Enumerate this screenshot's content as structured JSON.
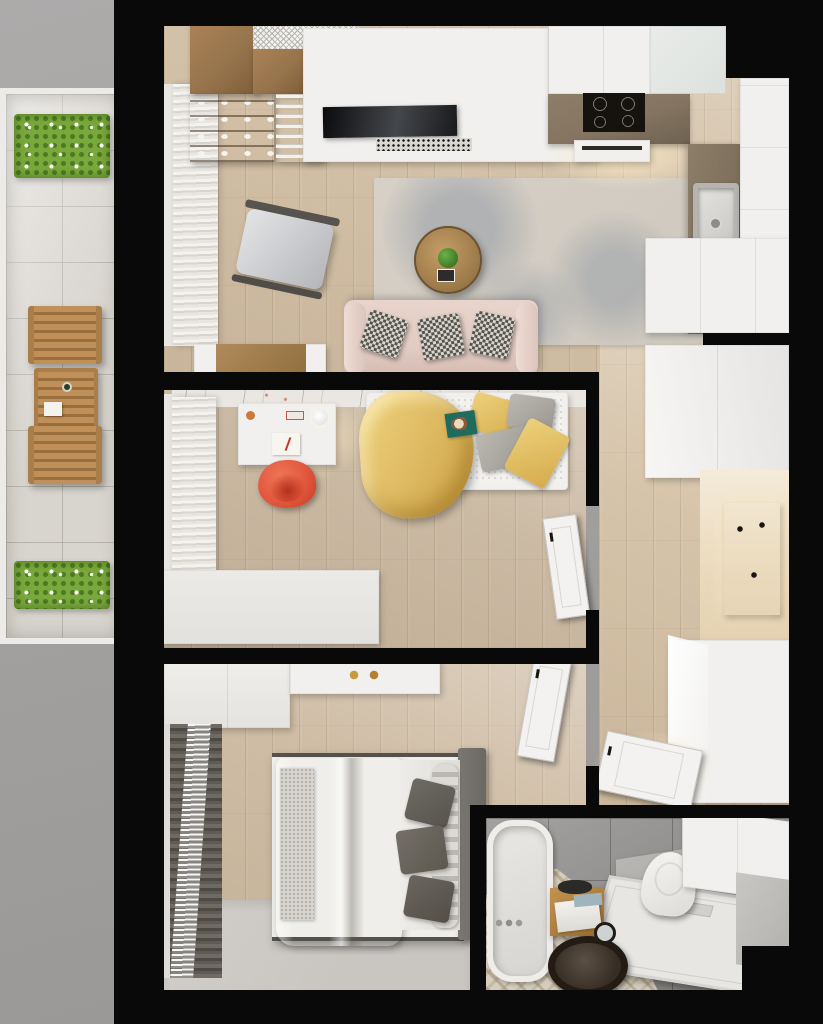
{
  "meta": {
    "type": "3d-rendered-floor-plan",
    "view": "top-down",
    "visible_text": "none",
    "canvas": {
      "width_px": 823,
      "height_px": 1024
    }
  },
  "palette": {
    "exterior_ground": "#a3a1a0",
    "exterior_ground_light": "#adabaa",
    "wall": "#090909",
    "wood_floor": "#d4c2a9",
    "balcony_tile": "#d8d4ce",
    "balcony_frame": "#edebe7",
    "plant_green": "#79a83c",
    "wood_furniture": "#96744c",
    "entry_panel_wood": "#b38240",
    "white_furniture": "#f1f0ee",
    "marble": "#eae7e2",
    "rug_living": "#cdc7bd",
    "sofa_pink": "#e2ccc4",
    "pillow_dark": "#55534b",
    "yellow_blanket": "#e0bd66",
    "accent_chair_red": "#e0563c",
    "teal_accent": "#1f6b5e",
    "kitchen_counter": "#847461",
    "cooktop_black": "#16130e",
    "sink_steel": "#c9c8c4",
    "gray_bed": "#a39e98",
    "bed_headboard": "#6b6862",
    "bedroom_rug": "#c9c6c2",
    "curtain_light": "#e9e6e1",
    "curtain_dark": "#4d4943",
    "bathroom_wall_tile": "#8f8d8b",
    "bathroom_floor_mosaic": "#d6cdbd",
    "shower_tray": "#e8e6e3",
    "door_white": "#f3f2f0"
  },
  "rooms": [
    {
      "id": "balcony",
      "name": "Balcony",
      "floor": "stone tile",
      "furniture": [
        "planter box (top)",
        "folding wood chair",
        "slatted wood table",
        "folding wood chair",
        "planter box (bottom)"
      ]
    },
    {
      "id": "living-room",
      "name": "Living room",
      "floor": "light oak plank",
      "furniture": [
        "wood wardrobe",
        "wood hutch",
        "open shelf unit with dishes",
        "bookshelf",
        "mesh vent panel",
        "white TV wall unit",
        "TV",
        "speckled media mat",
        "light curtains",
        "armchair with wood frame",
        "area rug",
        "round wood coffee table with plant",
        "pink sofa with patterned pillows",
        "desk with wood top"
      ]
    },
    {
      "id": "kitchen",
      "name": "Kitchen",
      "floor": "light oak plank",
      "furniture": [
        "upper cabinet run",
        "glass upper cabinet",
        "counter with cooktop",
        "built-in oven",
        "side counter with sink",
        "tall cabinet column",
        "lower cabinet block"
      ]
    },
    {
      "id": "office",
      "name": "Office / guest room",
      "floor": "light oak plank",
      "furniture": [
        "marble wall band",
        "light curtains",
        "desk with lamp and open book",
        "red shell chair",
        "white sideboard",
        "daybed with yellow blanket",
        "yellow and gray pillows",
        "teal book",
        "interior door (ajar)"
      ]
    },
    {
      "id": "hallway",
      "name": "Hallway / entry",
      "floor": "light oak plank",
      "furniture": [
        "tall wardrobe",
        "lit entry wall",
        "wood coat panel with hooks",
        "entry bench cabinet",
        "open bathroom door"
      ]
    },
    {
      "id": "bedroom",
      "name": "Bedroom",
      "floor": "light oak plank + gray rug",
      "furniture": [
        "wardrobe",
        "desk",
        "dark curtains",
        "double bed with gray duvet",
        "textured runner",
        "dark gray pillows",
        "rolled blanket",
        "dark headboard",
        "gray floor rug",
        "interior door (ajar)"
      ]
    },
    {
      "id": "bathroom",
      "name": "Bathroom",
      "floor": "mosaic tile",
      "furniture": [
        "bathtub",
        "gray ledge",
        "toilet",
        "angled shower tray",
        "wall cabinets",
        "wood stool with towels",
        "round dark tray with hand mirror"
      ]
    }
  ]
}
